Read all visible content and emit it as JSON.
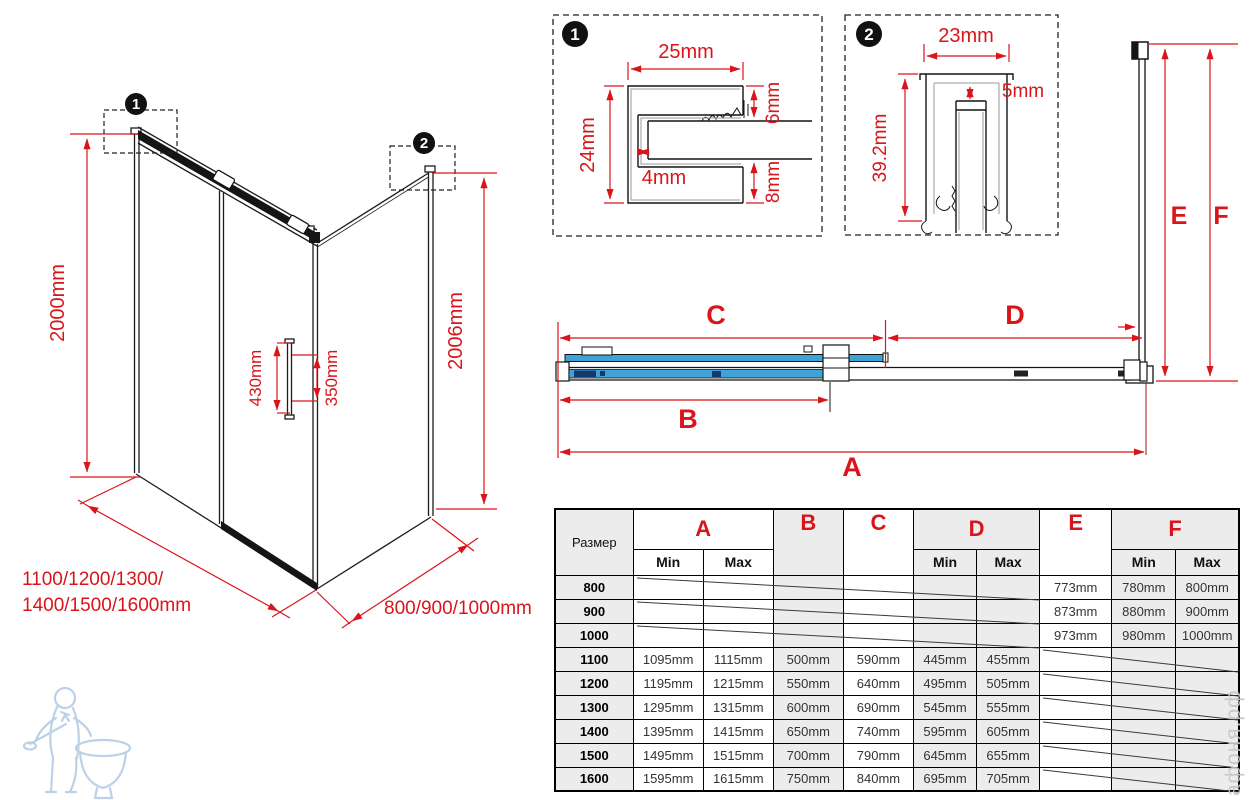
{
  "colors": {
    "dim_red": "#d9151b",
    "glass_blue": "#3fa3d8",
    "glass_dark": "#0f3a6e",
    "table_shade": "#ececec",
    "watermark_gray": "#c6c6c6",
    "logo_blue": "#b5cde6"
  },
  "callouts": {
    "one": "1",
    "two": "2"
  },
  "detail1": {
    "width_top": "25mm",
    "height_left": "24mm",
    "gap": "4mm",
    "top_right": "6mm",
    "bottom_right": "8mm"
  },
  "detail2": {
    "width_top": "23mm",
    "gap": "5mm",
    "height_left": "39.2mm"
  },
  "iso": {
    "height_left": "2000mm",
    "height_right": "2006mm",
    "handle_height": "430mm",
    "handle_offset": "350mm",
    "front_widths_line1": "1100/1200/1300/",
    "front_widths_line2": "1400/1500/1600mm",
    "side_widths": "800/900/1000mm"
  },
  "plan": {
    "a": "A",
    "b": "B",
    "c": "C",
    "d": "D",
    "e": "E",
    "f": "F"
  },
  "table": {
    "size_header": "Размер",
    "min": "Min",
    "max": "Max",
    "letters": {
      "a": "A",
      "b": "B",
      "c": "C",
      "d": "D",
      "e": "E",
      "f": "F"
    },
    "rows": [
      {
        "cells": [
          "800",
          "",
          "",
          "",
          "",
          "",
          "",
          "773mm",
          "780mm",
          "800mm"
        ]
      },
      {
        "cells": [
          "900",
          "",
          "",
          "",
          "",
          "",
          "",
          "873mm",
          "880mm",
          "900mm"
        ]
      },
      {
        "cells": [
          "1000",
          "",
          "",
          "",
          "",
          "",
          "",
          "973mm",
          "980mm",
          "1000mm"
        ]
      },
      {
        "cells": [
          "1100",
          "1095mm",
          "1115mm",
          "500mm",
          "590mm",
          "445mm",
          "455mm",
          "",
          "",
          ""
        ]
      },
      {
        "cells": [
          "1200",
          "1195mm",
          "1215mm",
          "550mm",
          "640mm",
          "495mm",
          "505mm",
          "",
          "",
          ""
        ]
      },
      {
        "cells": [
          "1300",
          "1295mm",
          "1315mm",
          "600mm",
          "690mm",
          "545mm",
          "555mm",
          "",
          "",
          ""
        ]
      },
      {
        "cells": [
          "1400",
          "1395mm",
          "1415mm",
          "650mm",
          "740mm",
          "595mm",
          "605mm",
          "",
          "",
          ""
        ]
      },
      {
        "cells": [
          "1500",
          "1495mm",
          "1515mm",
          "700mm",
          "790mm",
          "645mm",
          "655mm",
          "",
          "",
          ""
        ]
      },
      {
        "cells": [
          "1600",
          "1595mm",
          "1615mm",
          "750mm",
          "840mm",
          "695mm",
          "705mm",
          "",
          "",
          ""
        ]
      }
    ]
  },
  "watermark": {
    "site": "афоня.рф"
  }
}
